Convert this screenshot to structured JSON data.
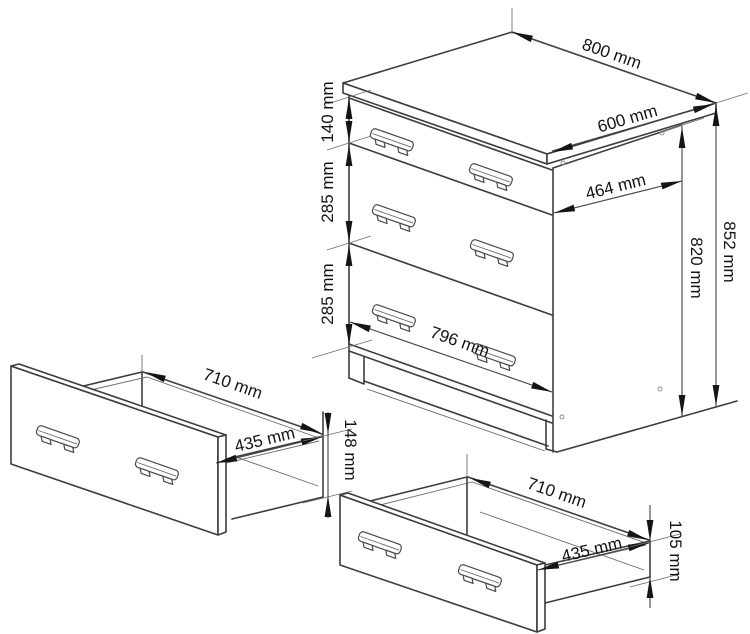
{
  "diagram": {
    "units": "mm",
    "subject": "three-drawer cabinet technical dimension drawing",
    "cabinet": {
      "top_width": "800 mm",
      "top_depth": "600 mm",
      "body_depth": "464 mm",
      "drawer1_height": "140 mm",
      "drawer2_height": "285 mm",
      "drawer3_height": "285 mm",
      "body_height": "820 mm",
      "total_height": "852 mm",
      "front_width": "796 mm"
    },
    "left_drawer": {
      "width": "710 mm",
      "depth": "435 mm",
      "height": "148 mm"
    },
    "right_drawer": {
      "width": "710 mm",
      "depth": "435 mm",
      "height": "105 mm"
    }
  }
}
